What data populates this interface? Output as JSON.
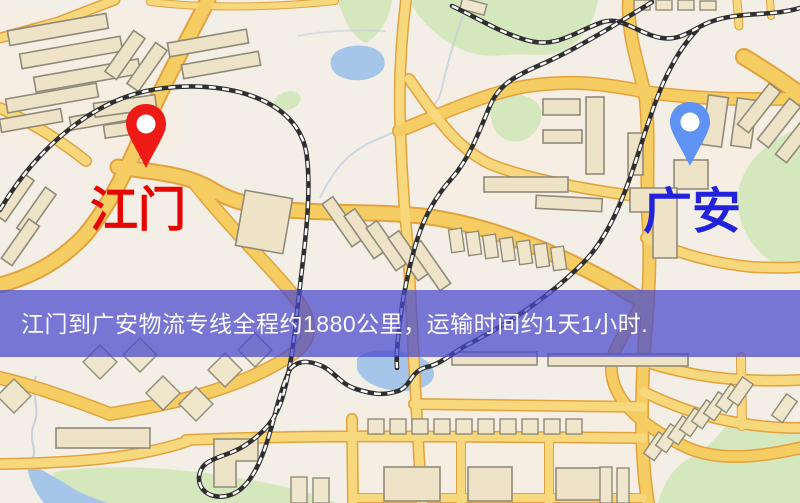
{
  "banner": {
    "text": "江门到广安物流专线全程约1880公里，运输时间约1天1小时.",
    "background": "#4949ce",
    "text_color": "#fafaff"
  },
  "markers": {
    "origin": {
      "label": "江门",
      "pin_color": "#ee1a16",
      "label_color": "#e60400"
    },
    "destination": {
      "label": "广安",
      "pin_color": "#5e92f3",
      "label_color": "#2222dd"
    }
  },
  "map_palette": {
    "land": "#f3efe6",
    "road_fill": "#f8d87c",
    "road_casing": "#e2a23e",
    "park": "#d5e7bd",
    "water": "#a5c6e9",
    "building": "#eee3c6",
    "railway_dark": "#2f2f2f",
    "railway_light": "#ffffff"
  }
}
